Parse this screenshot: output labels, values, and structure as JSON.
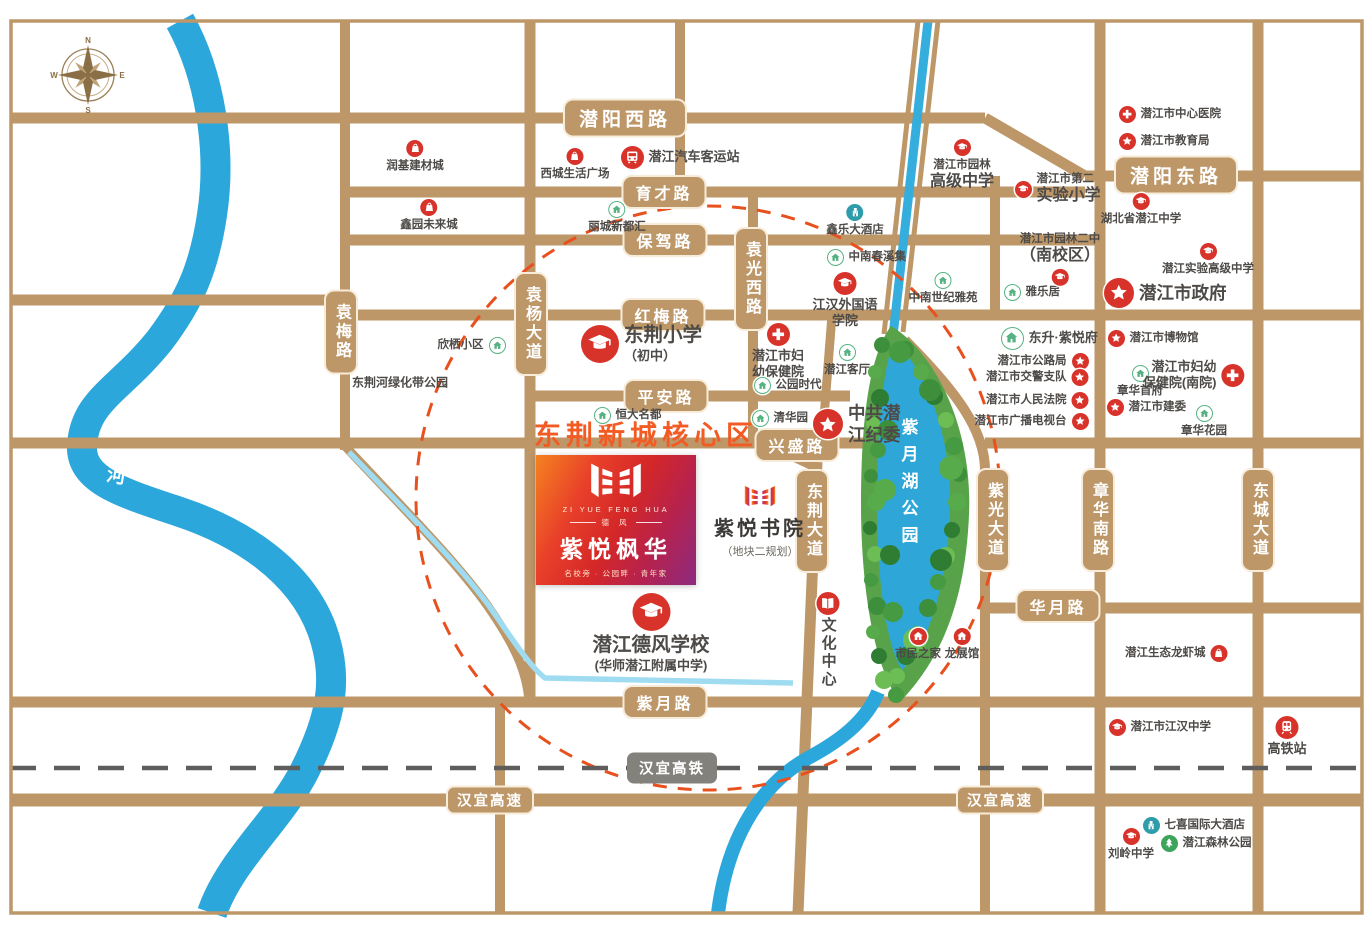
{
  "map": {
    "frame_color": "#bd9768",
    "road_color": "#bd9768",
    "river_color": "#2ca7dc",
    "stream_color": "#9fdcf2",
    "lake_color": "#2ea7d8",
    "park_color": "#58a34a",
    "circle_color": "#e8501e",
    "rail_color": "#5e5d5b",
    "accent_red": "#d8332a",
    "accent_green": "#56b381",
    "accent_teal": "#2f9cab",
    "core_area_label": "东荆新城核心区",
    "river_park_label": "东荆河绿化带公园",
    "lake_park_label": "紫月湖公园",
    "river_name_chars": [
      "东",
      "荆",
      "河"
    ],
    "compass": {
      "n": "N",
      "e": "E",
      "s": "S",
      "w": "W"
    }
  },
  "project": {
    "logo_en": "ZI YUE FENG HUA",
    "logo_tag": "德  风",
    "logo_cn": "紫悦枫华",
    "logo_sub": "名校旁 · 公园畔 · 青年家"
  },
  "academy": {
    "name": "紫悦书院",
    "sub": "（地块二规划）"
  },
  "road_labels": [
    {
      "text": "潜阳西路",
      "x": 625,
      "y": 118,
      "dir": "h",
      "style": "roadL"
    },
    {
      "text": "育才路",
      "x": 664,
      "y": 192,
      "dir": "h",
      "style": "road"
    },
    {
      "text": "保驾路",
      "x": 665,
      "y": 240,
      "dir": "h",
      "style": "road"
    },
    {
      "text": "红梅路",
      "x": 663,
      "y": 315,
      "dir": "h",
      "style": "road"
    },
    {
      "text": "平安路",
      "x": 666,
      "y": 396,
      "dir": "h",
      "style": "road"
    },
    {
      "text": "兴盛路",
      "x": 797,
      "y": 445,
      "dir": "h",
      "style": "road"
    },
    {
      "text": "潜阳东路",
      "x": 1176,
      "y": 175,
      "dir": "h",
      "style": "roadL"
    },
    {
      "text": "华月路",
      "x": 1058,
      "y": 606,
      "dir": "h",
      "style": "road"
    },
    {
      "text": "紫月路",
      "x": 665,
      "y": 702,
      "dir": "h",
      "style": "road"
    },
    {
      "text": "汉宜高铁",
      "x": 672,
      "y": 768,
      "dir": "h",
      "style": "rail"
    },
    {
      "text": "汉宜高速",
      "x": 490,
      "y": 800,
      "dir": "h",
      "style": "hwy"
    },
    {
      "text": "汉宜高速",
      "x": 1000,
      "y": 800,
      "dir": "h",
      "style": "hwy"
    },
    {
      "text": "袁梅路",
      "x": 341,
      "y": 332,
      "dir": "v",
      "style": "road"
    },
    {
      "text": "袁杨大道",
      "x": 531,
      "y": 324,
      "dir": "v",
      "style": "road"
    },
    {
      "text": "袁光西路",
      "x": 751,
      "y": 279,
      "dir": "v",
      "style": "road"
    },
    {
      "text": "东荆大道",
      "x": 812,
      "y": 521,
      "dir": "v",
      "style": "road"
    },
    {
      "text": "紫光大道",
      "x": 993,
      "y": 520,
      "dir": "v",
      "style": "road"
    },
    {
      "text": "章华南路",
      "x": 1098,
      "y": 520,
      "dir": "v",
      "style": "road"
    },
    {
      "text": "东城大道",
      "x": 1258,
      "y": 520,
      "dir": "v",
      "style": "road"
    }
  ],
  "pois": [
    {
      "lines": [
        "润基建材城"
      ],
      "type": "shop",
      "x": 415,
      "y": 148,
      "lay": "v",
      "size": "sm"
    },
    {
      "lines": [
        "西城生活广场"
      ],
      "type": "shop",
      "x": 575,
      "y": 156,
      "lay": "v",
      "size": "sm"
    },
    {
      "lines": [
        "潜江汽车客运站"
      ],
      "type": "bus",
      "x": 632,
      "y": 157,
      "lay": "r",
      "size": "md"
    },
    {
      "lines": [
        "鑫园未来城"
      ],
      "type": "shop",
      "x": 429,
      "y": 207,
      "lay": "v",
      "size": "sm"
    },
    {
      "lines": [
        "丽城新都汇"
      ],
      "type": "homeG",
      "x": 617,
      "y": 209,
      "lay": "v",
      "size": "sm"
    },
    {
      "lines": [
        "鑫乐大酒店"
      ],
      "type": "hotel",
      "x": 855,
      "y": 212,
      "lay": "v",
      "size": "sm"
    },
    {
      "lines": [
        "中南春溪集"
      ],
      "type": "homeG",
      "x": 835,
      "y": 257,
      "lay": "r",
      "size": "sm"
    },
    {
      "lines": [
        "江汉外国语",
        "学院"
      ],
      "type": "school",
      "x": 845,
      "y": 283,
      "lay": "vb",
      "size": "md"
    },
    {
      "lines": [
        "中南世纪雅苑"
      ],
      "type": "homeG",
      "x": 943,
      "y": 280,
      "lay": "v",
      "size": "sm"
    },
    {
      "lines": [
        "潜江市园林",
        "高级中学"
      ],
      "type": "school",
      "x": 962,
      "y": 147,
      "lay": "vb",
      "size": "sm"
    },
    {
      "lines": [
        "潜江市第二",
        "实验小学"
      ],
      "type": "school",
      "x": 1023,
      "y": 180,
      "lay": "r",
      "size": "sm"
    },
    {
      "lines": [
        "雅乐居"
      ],
      "type": "homeG",
      "x": 1012,
      "y": 292,
      "lay": "r",
      "size": "sm"
    },
    {
      "lines": [
        "潜江市园林二中",
        "（南校区）"
      ],
      "type": "school",
      "x": 1060,
      "y": 277,
      "lay": "b",
      "size": "sm"
    },
    {
      "lines": [
        "潜江市中心医院"
      ],
      "type": "hosp",
      "x": 1127,
      "y": 114,
      "lay": "r",
      "size": "sm"
    },
    {
      "lines": [
        "潜江市教育局"
      ],
      "type": "gov",
      "x": 1127,
      "y": 141,
      "lay": "r",
      "size": "sm"
    },
    {
      "lines": [
        "湖北省潜江中学"
      ],
      "type": "school",
      "x": 1141,
      "y": 201,
      "lay": "vb",
      "size": "sm"
    },
    {
      "lines": [
        "潜江实验高级中学"
      ],
      "type": "school",
      "x": 1208,
      "y": 251,
      "lay": "vb",
      "size": "sm"
    },
    {
      "lines": [
        "潜江市政府"
      ],
      "type": "gov",
      "x": 1119,
      "y": 293,
      "lay": "r",
      "size": "lg"
    },
    {
      "lines": [
        "东升·紫悦府"
      ],
      "type": "homeG",
      "x": 1012,
      "y": 338,
      "lay": "r",
      "size": "md"
    },
    {
      "lines": [
        "潜江市公路局"
      ],
      "type": "gov",
      "x": 1080,
      "y": 361,
      "lay": "l",
      "size": "sm"
    },
    {
      "lines": [
        "潜江市交警支队"
      ],
      "type": "gov",
      "x": 1080,
      "y": 377,
      "lay": "l",
      "size": "sm"
    },
    {
      "lines": [
        "潜江市人民法院"
      ],
      "type": "gov",
      "x": 1080,
      "y": 400,
      "lay": "l",
      "size": "sm"
    },
    {
      "lines": [
        "潜江市广播电视台"
      ],
      "type": "gov",
      "x": 1080,
      "y": 421,
      "lay": "l",
      "size": "sm"
    },
    {
      "lines": [
        "潜江市博物馆"
      ],
      "type": "gov",
      "x": 1116,
      "y": 338,
      "lay": "r",
      "size": "sm"
    },
    {
      "lines": [
        "章华首府"
      ],
      "type": "homeG",
      "x": 1140,
      "y": 373,
      "lay": "v",
      "size": "sm"
    },
    {
      "lines": [
        "潜江市妇幼",
        "保健院(南院)"
      ],
      "type": "hosp",
      "x": 1233,
      "y": 370,
      "lay": "l",
      "size": "md"
    },
    {
      "lines": [
        "潜江市建委"
      ],
      "type": "gov",
      "x": 1115,
      "y": 407,
      "lay": "r",
      "size": "sm"
    },
    {
      "lines": [
        "章华花园"
      ],
      "type": "homeG",
      "x": 1204,
      "y": 413,
      "lay": "v",
      "size": "sm"
    },
    {
      "lines": [
        "东荆小学",
        "（初中）"
      ],
      "type": "school",
      "x": 600,
      "y": 342,
      "lay": "r",
      "size": "xl"
    },
    {
      "lines": [
        "潜江市妇",
        "幼保健院"
      ],
      "type": "hosp",
      "x": 778,
      "y": 334,
      "lay": "vb",
      "size": "md"
    },
    {
      "lines": [
        "公园时代"
      ],
      "type": "homeG",
      "x": 762,
      "y": 385,
      "lay": "r",
      "size": "sm"
    },
    {
      "lines": [
        "潜江客厅"
      ],
      "type": "homeG",
      "x": 847,
      "y": 352,
      "lay": "v",
      "size": "sm"
    },
    {
      "lines": [
        "恒大名都"
      ],
      "type": "homeG",
      "x": 602,
      "y": 415,
      "lay": "r",
      "size": "sm"
    },
    {
      "lines": [
        "清华园"
      ],
      "type": "homeG",
      "x": 760,
      "y": 418,
      "lay": "r",
      "size": "sm"
    },
    {
      "lines": [
        "中共潜",
        "江纪委"
      ],
      "type": "gov",
      "x": 828,
      "y": 417,
      "lay": "r",
      "size": "lg"
    },
    {
      "lines": [
        "潜江德风学校",
        "(华师潜江附属中学)"
      ],
      "type": "school",
      "x": 651,
      "y": 612,
      "lay": "vb",
      "size": "xl"
    },
    {
      "lines": [
        "文化中心"
      ],
      "type": "book",
      "x": 828,
      "y": 603,
      "lay": "vb",
      "size": "md",
      "vert": true
    },
    {
      "lines": [
        "市民之家"
      ],
      "type": "homeR",
      "x": 918,
      "y": 636,
      "lay": "v",
      "size": "sm"
    },
    {
      "lines": [
        "龙展馆"
      ],
      "type": "homeR",
      "x": 962,
      "y": 636,
      "lay": "v",
      "size": "sm"
    },
    {
      "lines": [
        "潜江生态龙虾城"
      ],
      "type": "shop",
      "x": 1219,
      "y": 653,
      "lay": "l",
      "size": "sm"
    },
    {
      "lines": [
        "潜江市江汉中学"
      ],
      "type": "school",
      "x": 1117,
      "y": 727,
      "lay": "r",
      "size": "sm"
    },
    {
      "lines": [
        "高铁站"
      ],
      "type": "train",
      "x": 1287,
      "y": 727,
      "lay": "vb",
      "size": "md"
    },
    {
      "lines": [
        "七喜国际大酒店"
      ],
      "type": "hotel",
      "x": 1151,
      "y": 825,
      "lay": "r",
      "size": "sm"
    },
    {
      "lines": [
        "刘岭中学"
      ],
      "type": "school",
      "x": 1131,
      "y": 836,
      "lay": "v",
      "size": "sm"
    },
    {
      "lines": [
        "潜江森林公园"
      ],
      "type": "tree",
      "x": 1169,
      "y": 843,
      "lay": "r",
      "size": "sm"
    },
    {
      "lines": [
        "欣栖小区"
      ],
      "type": "homeG",
      "x": 497,
      "y": 345,
      "lay": "l",
      "size": "sm"
    }
  ]
}
